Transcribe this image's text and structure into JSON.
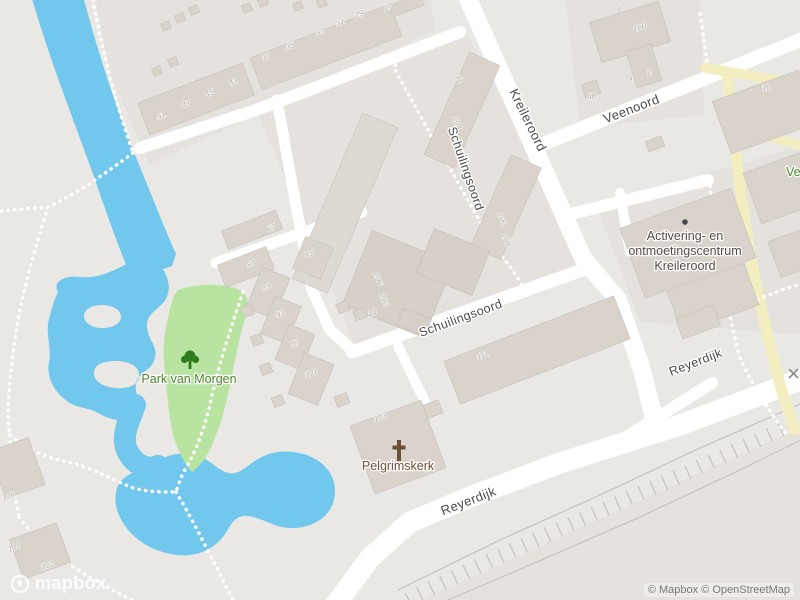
{
  "streets": [
    {
      "name": "Kreileroord"
    },
    {
      "name": "Veenoord"
    },
    {
      "name": "Schuilingsoord"
    },
    {
      "name": "Schuilingsoord"
    },
    {
      "name": "Reyerdijk"
    },
    {
      "name": "Reyerdijk"
    }
  ],
  "pois": {
    "park": {
      "name": "Park van Morgen",
      "icon": "tree-icon"
    },
    "church": {
      "name": "Pelgrimskerk",
      "icon": "cross-icon"
    },
    "community_centre": {
      "line1": "Activering- en",
      "line2": "ontmoetingscentrum",
      "line3": "Kreileroord",
      "icon": "dot-icon"
    },
    "edge_clipped_label": "Ve"
  },
  "house_numbers": [
    "51",
    "47",
    "45",
    "43",
    "37",
    "35",
    "33",
    "31",
    "29",
    "27",
    "8",
    "100",
    "4",
    "2",
    "48",
    "18",
    "11",
    "204",
    "200",
    "208",
    "206",
    "202",
    "10",
    "111",
    "103",
    "67",
    "85",
    "87",
    "89",
    "93",
    "97",
    "101",
    "106",
    "100",
    "102"
  ],
  "branding": {
    "logo_text": "mapbox",
    "attribution": "© Mapbox © OpenStreetMap"
  },
  "colors": {
    "water": "#72c8ec",
    "park_fill": "#b9e3a0",
    "land": "#eae8e5",
    "block": "#e5e2de",
    "road": "#ffffff",
    "building": "#d9d3cb",
    "yellow_path": "#f2eebf",
    "street_label": "#4b4b49",
    "house_number": "#b2aba2",
    "park_label": "#4d8526",
    "church_label": "#6d5139",
    "centre_label": "#554b42"
  }
}
